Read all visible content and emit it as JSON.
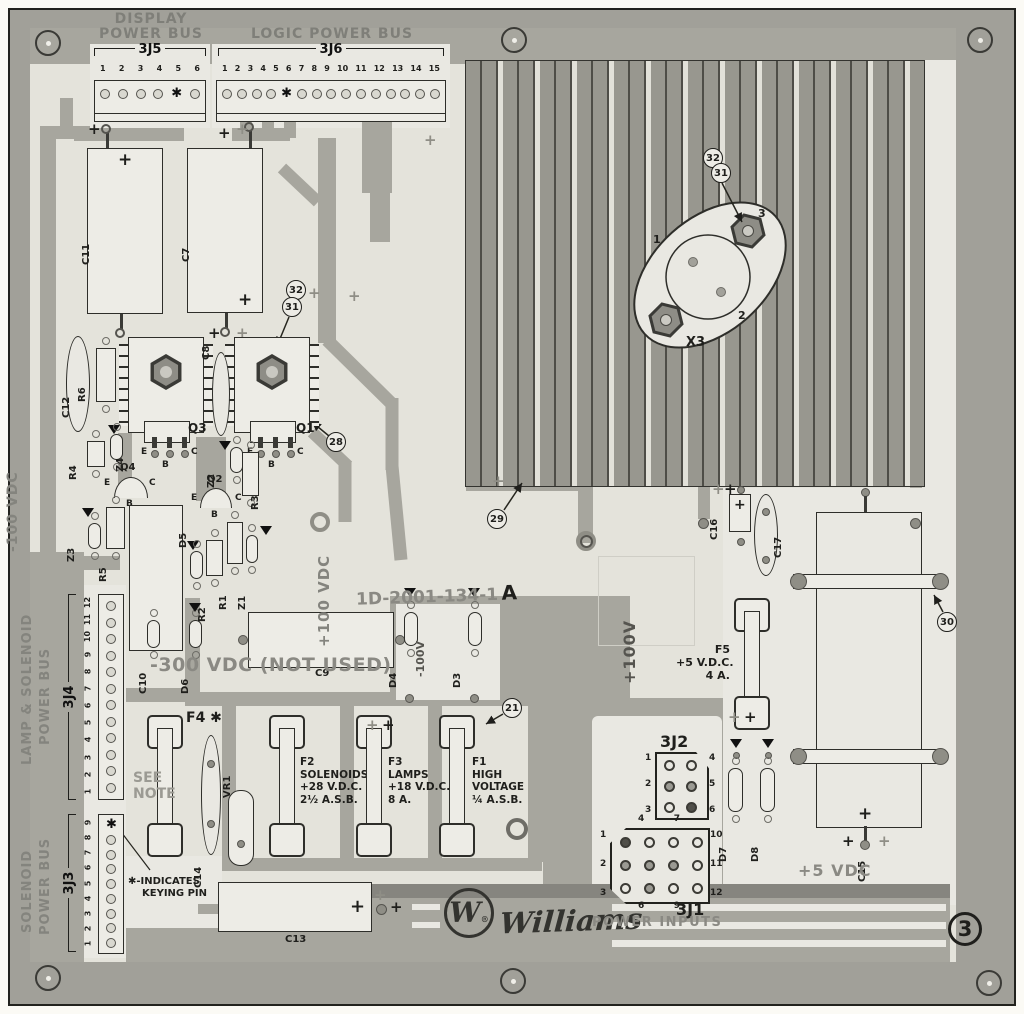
{
  "sheet": {
    "number": "3"
  },
  "silkscreen": {
    "display_bus": [
      "DISPLAY",
      "POWER BUS"
    ],
    "logic_bus": "LOGIC POWER BUS",
    "lamp_bus": [
      "LAMP & SOLENOID",
      "POWER BUS"
    ],
    "solenoid_bus": [
      "SOLENOID",
      "POWER BUS"
    ],
    "power_inputs": "POWER INPUTS",
    "keying_note": [
      "✱-INDICATES",
      "KEYING PIN"
    ],
    "see_note": [
      "SEE",
      "NOTE"
    ],
    "not_used": "-300 VDC (NOT USED)",
    "part_number": "1D-2001-134-1",
    "revision": "A"
  },
  "voltages": {
    "minus100": "-100 VDC",
    "plus100": "+100 VDC",
    "plus100_short": "+100V",
    "minus100_short": "-100V",
    "plus5": "+5 VDC"
  },
  "brand": {
    "initial": "W",
    "reg": "®",
    "name": "Williams"
  },
  "connectors": {
    "j5": {
      "label": "3J5",
      "nums": [
        "1",
        "2",
        "3",
        "4",
        "5",
        "6"
      ],
      "holes": [
        "",
        "",
        "",
        "",
        "✱",
        ""
      ]
    },
    "j6": {
      "label": "3J6",
      "nums": [
        "1",
        "2",
        "3",
        "4",
        "5",
        "6",
        "7",
        "8",
        "9",
        "10",
        "11",
        "12",
        "13",
        "14",
        "15"
      ],
      "holes": [
        "",
        "",
        "",
        "",
        "✱",
        "",
        "",
        "",
        "",
        "",
        "",
        "",
        "",
        "",
        ""
      ]
    },
    "j4": {
      "label": "3J4",
      "nums": [
        "12",
        "11",
        "10",
        "9",
        "8",
        "7",
        "6",
        "5",
        "4",
        "3",
        "2",
        "1"
      ],
      "holes": [
        "",
        "",
        "",
        "",
        "",
        "",
        "",
        "",
        "",
        "",
        "",
        ""
      ]
    },
    "j3": {
      "label": "3J3",
      "nums": [
        "9",
        "8",
        "7",
        "6",
        "5",
        "4",
        "3",
        "2",
        "1"
      ],
      "holes": [
        "✱",
        "",
        "",
        "",
        "",
        "",
        "",
        "",
        ""
      ]
    },
    "j2": {
      "label": "3J2",
      "left": [
        "1",
        "2",
        "3"
      ],
      "right": [
        "4",
        "5",
        "6"
      ]
    },
    "j1": {
      "label": "3J1",
      "left": [
        "1",
        "2",
        "3"
      ],
      "right": [
        "10",
        "11",
        "12"
      ],
      "top": [
        "4",
        "7"
      ],
      "bottom": [
        "6",
        "9"
      ]
    }
  },
  "fuses": {
    "f4": {
      "label": "F4 ✱"
    },
    "f2": {
      "lines": [
        "F2",
        "SOLENOIDS",
        "+28 V.D.C.",
        "2½ A.S.B."
      ]
    },
    "f3": {
      "lines": [
        "F3",
        "LAMPS",
        "+18 V.D.C.",
        "8 A."
      ]
    },
    "f1": {
      "lines": [
        "F1",
        "HIGH",
        "VOLTAGE",
        "¼ A.S.B."
      ]
    },
    "f5": {
      "lines": [
        "F5",
        "+5 V.D.C.",
        "4 A."
      ]
    }
  },
  "refs": {
    "c7": "C7",
    "c8": "C8",
    "c9": "C9",
    "c10": "C10",
    "c11": "C11",
    "c12": "C12",
    "c13": "C13",
    "c14": "C14",
    "c15": "C15",
    "c16": "C16",
    "c17": "C17",
    "r1": "R1",
    "r2": "R2",
    "r3": "R3",
    "r4": "R4",
    "r5": "R5",
    "r6": "R6",
    "d3": "D3",
    "d4": "D4",
    "d5": "D5",
    "d6": "D6",
    "d7": "D7",
    "d8": "D8",
    "z1": "Z1",
    "z2": "Z2",
    "z3": "Z3",
    "z4": "Z4",
    "q1": "Q1",
    "q2": "Q2",
    "q3": "Q3",
    "q4": "Q4",
    "vr1": "VR1",
    "x3": "X3"
  },
  "pins": {
    "e": "E",
    "b": "B",
    "c": "C",
    "x1": "1",
    "x2": "2",
    "x3": "3"
  },
  "callouts": {
    "n21": "21",
    "n28": "28",
    "n29": "29",
    "n30": "30",
    "n31": "31",
    "n32": "32"
  }
}
